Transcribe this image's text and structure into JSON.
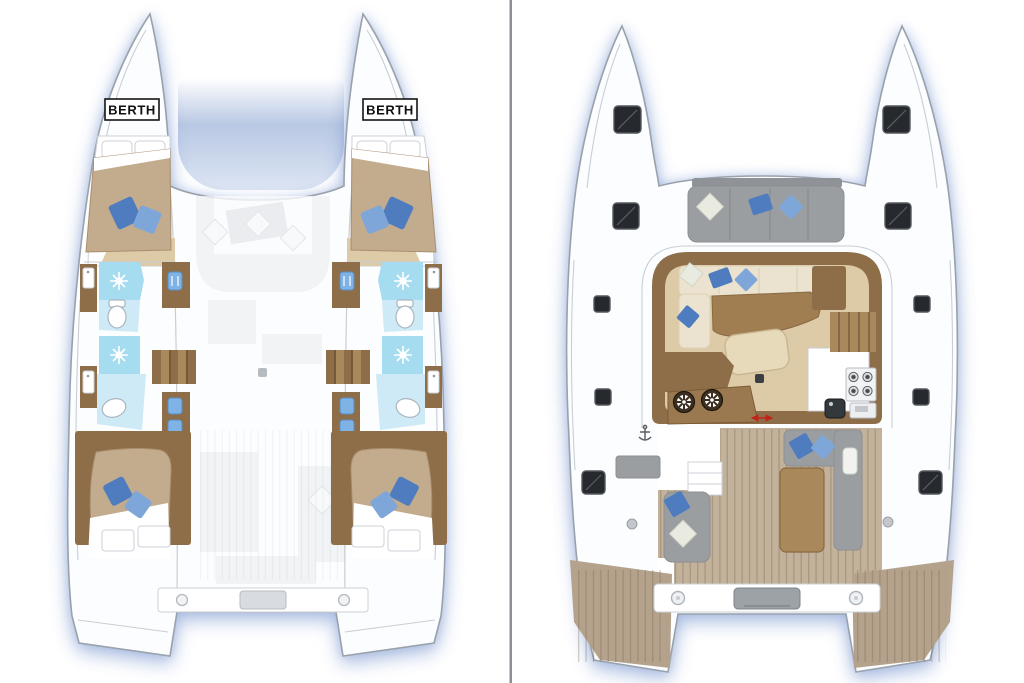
{
  "panels": {
    "lower_deck": {
      "berth_label_left": "BERTH",
      "berth_label_right": "BERTH"
    },
    "main_deck": {}
  },
  "icons": {
    "shower": "white sunburst on cyan",
    "toilet": "white oval bowl",
    "sink": "white basin with faucet dot",
    "vanity_sink": "small blue basin",
    "winch": "dark circle with white 8-spoke star",
    "stove": "2x2 burner circles",
    "oven": "rectangle with display slot",
    "galley_sink": "dark rounded square",
    "deck_hatch": "dark glossy rounded square",
    "pillow": "rotated square cushion",
    "windlass": "small gray anchor",
    "sliding_door": "red double arrow",
    "transom_bolt": "small circle fitting"
  },
  "colors": {
    "divider": "#8b9096",
    "hull_fill": "#fcfdfe",
    "hull_stroke": "#99a1ab",
    "line_soft": "#c9ced5",
    "tramp_mid": "#b9c8e4",
    "tramp_low": "#dce5f3",
    "bath": "#a6dcf0",
    "bath_light": "#cdeaf6",
    "wood": "#8d6e49",
    "wood_light": "#a9895c",
    "floor_wood": "#ddcaa6",
    "mattress": "#c3ac8e",
    "mattress_edge": "#a98e6c",
    "sofa_cream": "#ebe3cf",
    "sofa_cream_dark": "#ded2b6",
    "pillow_blue": "#4f7cbf",
    "pillow_blue_light": "#7fa6d9",
    "pillow_cream": "#e9ebe0",
    "seat_gray": "#9b9ea1",
    "seat_gray_dark": "#8c8f92",
    "teak": "#c2b19b",
    "teak_dark": "#b4a28c",
    "stripe_dark": "rgba(110,88,62,0.28)",
    "hatch": "#26292d",
    "hatch_hi": "#55595e",
    "ghost": "#eff1f3",
    "ghost_line": "#dde0e4",
    "red_accent": "#c22418",
    "label_ink": "#111111",
    "toilet_stroke": "#aab6c0",
    "vanity_blue": "#7fb3e6"
  }
}
